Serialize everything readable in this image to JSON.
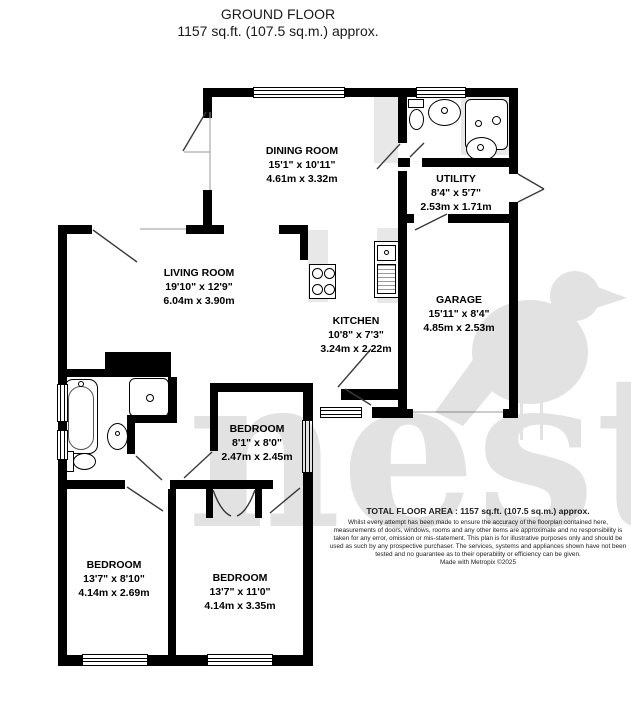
{
  "title": {
    "line1": "GROUND FLOOR",
    "line2": "1157 sq.ft. (107.5 sq.m.) approx."
  },
  "rooms": [
    {
      "name": "DINING ROOM",
      "imperial": "15'1\" x 10'11\"",
      "metric": "4.61m x 3.32m"
    },
    {
      "name": "UTILITY",
      "imperial": "8'4\" x 5'7\"",
      "metric": "2.53m x 1.71m"
    },
    {
      "name": "LIVING ROOM",
      "imperial": "19'10\" x 12'9\"",
      "metric": "6.04m x 3.90m"
    },
    {
      "name": "KITCHEN",
      "imperial": "10'8\" x 7'3\"",
      "metric": "3.24m x 2.22m"
    },
    {
      "name": "GARAGE",
      "imperial": "15'11\" x 8'4\"",
      "metric": "4.85m x 2.53m"
    },
    {
      "name": "BEDROOM",
      "imperial": "8'1\" x 8'0\"",
      "metric": "2.47m x 2.45m"
    },
    {
      "name": "BEDROOM",
      "imperial": "13'7\" x 8'10\"",
      "metric": "4.14m x 2.69m"
    },
    {
      "name": "BEDROOM",
      "imperial": "13'7\" x 11'0\"",
      "metric": "4.14m x 3.35m"
    }
  ],
  "footer": {
    "total_area": "TOTAL FLOOR AREA : 1157 sq.ft. (107.5 sq.m.) approx.",
    "disclaimer": "Whilst every attempt has been made to ensure the accuracy of the floorplan contained here, measurements of doors, windows, rooms and any other items are approximate and no responsibility is taken for any error, omission or mis-statement. This plan is for illustrative purposes only and should be used as such by any prospective purchaser. The services, systems and appliances shown have not been tested and no guarantee as to their operability or efficiency can be given.",
    "credit": "Made with Metropix ©2025"
  },
  "watermark": {
    "text": "nest"
  },
  "colors": {
    "wall": "#000000",
    "counter": "#e8e8e8",
    "watermark": "#e2e2e2",
    "ink": "#111111"
  }
}
